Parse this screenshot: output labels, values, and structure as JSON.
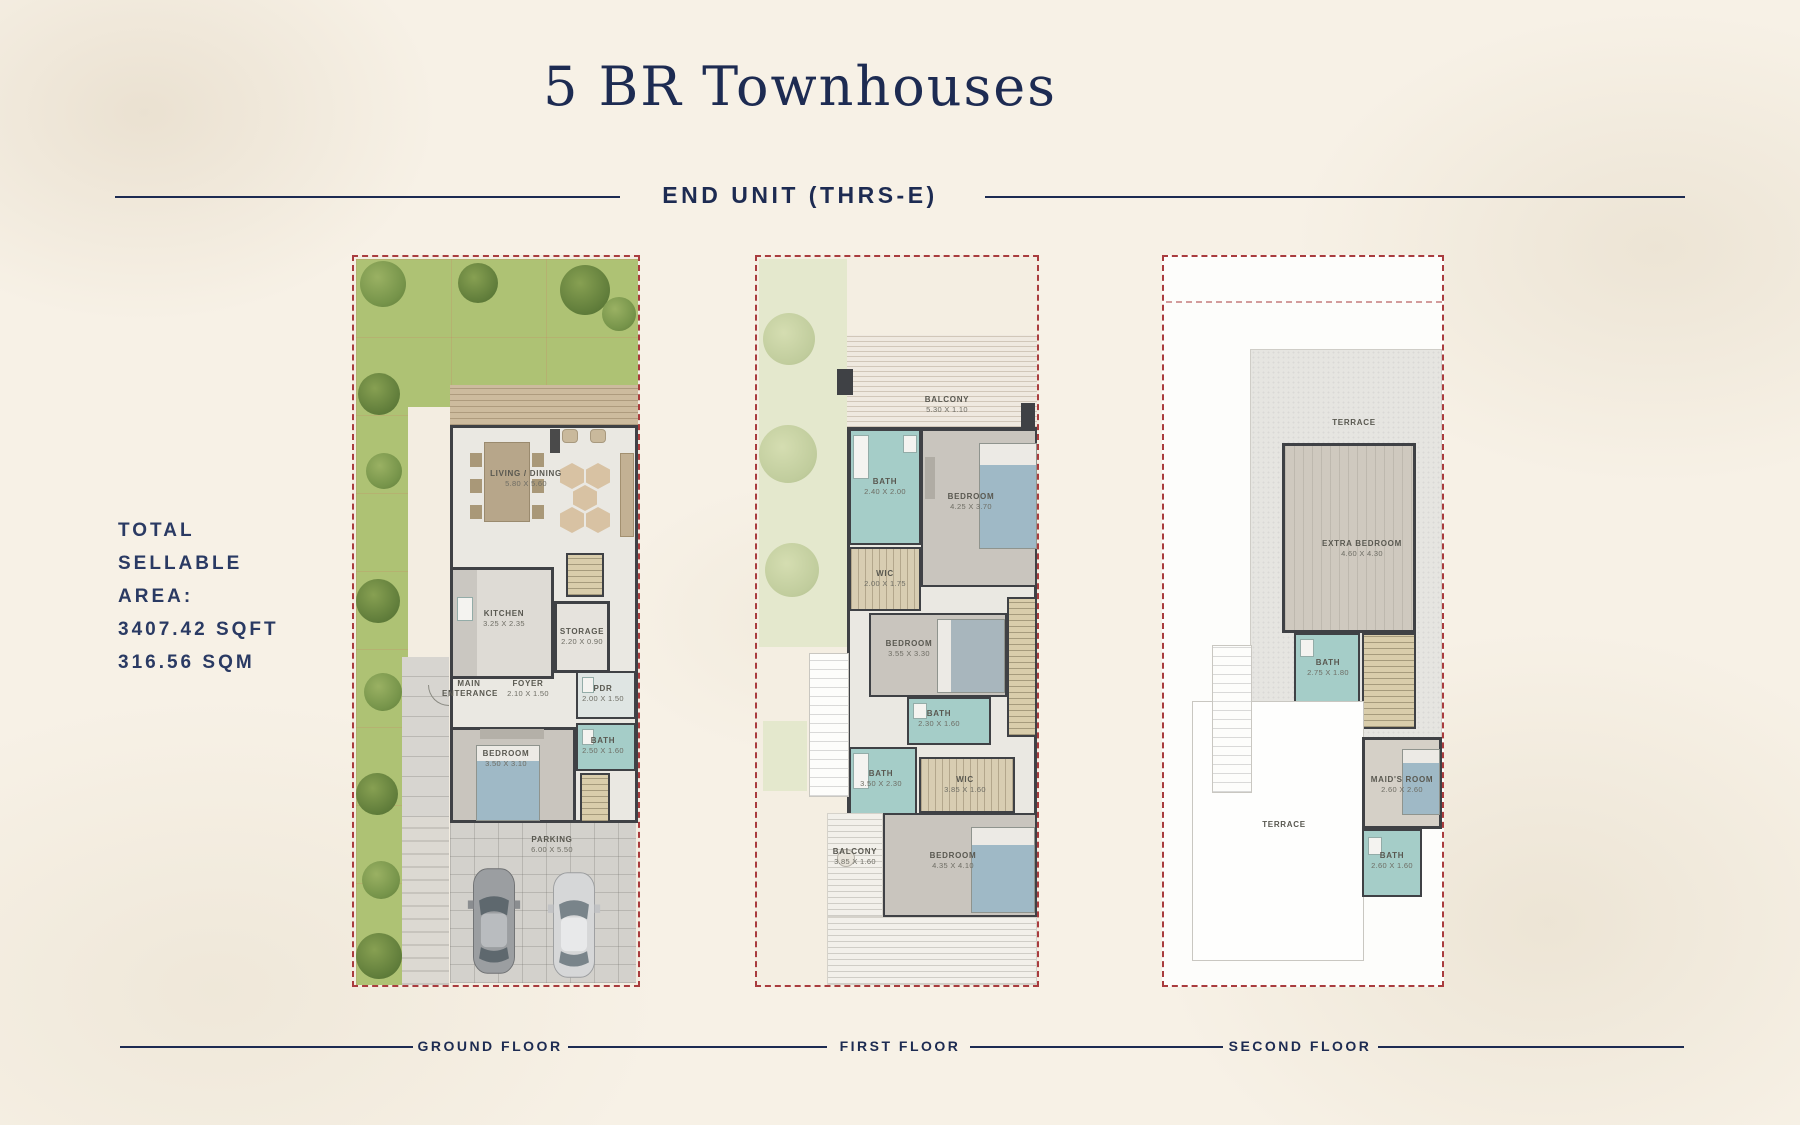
{
  "header": {
    "title": "5 BR Townhouses",
    "subtitle": "END UNIT (THRS-E)"
  },
  "area": {
    "l1": "TOTAL",
    "l2": "SELLABLE",
    "l3": "AREA:",
    "l4": "3407.42 SQFT",
    "l5": "316.56 SQM"
  },
  "floors": {
    "ground": {
      "label": "GROUND FLOOR",
      "rooms": {
        "living": {
          "name": "LIVING / DINING",
          "dims": "5.80 X 5.60"
        },
        "kitchen": {
          "name": "KITCHEN",
          "dims": "3.25 X 2.35"
        },
        "storage": {
          "name": "STORAGE",
          "dims": "2.20 X 0.90"
        },
        "entrance": {
          "name": "MAIN ENTERANCE",
          "dims": ""
        },
        "foyer": {
          "name": "FOYER",
          "dims": "2.10 X 1.50"
        },
        "pdr": {
          "name": "PDR",
          "dims": "2.00 X 1.50"
        },
        "bath": {
          "name": "BATH",
          "dims": "2.50 X 1.60"
        },
        "bedroom": {
          "name": "BEDROOM",
          "dims": "3.50 X 3.10"
        },
        "parking": {
          "name": "PARKING",
          "dims": "6.00 X 5.50"
        }
      }
    },
    "first": {
      "label": "FIRST FLOOR",
      "rooms": {
        "balcony1": {
          "name": "BALCONY",
          "dims": "5.30 X 1.10"
        },
        "bath1": {
          "name": "BATH",
          "dims": "2.40 X 2.00"
        },
        "bedroom1": {
          "name": "BEDROOM",
          "dims": "4.25 X 3.70"
        },
        "wic1": {
          "name": "WIC",
          "dims": "2.00 X 1.75"
        },
        "bedroom2": {
          "name": "BEDROOM",
          "dims": "3.55 X 3.30"
        },
        "bath2": {
          "name": "BATH",
          "dims": "2.30 X 1.60"
        },
        "bath3": {
          "name": "BATH",
          "dims": "3.50 X 2.30"
        },
        "wic2": {
          "name": "WIC",
          "dims": "3.85 X 1.60"
        },
        "bedroom3": {
          "name": "BEDROOM",
          "dims": "4.35 X 4.10"
        },
        "balcony2": {
          "name": "BALCONY",
          "dims": "3.85 X 1.60"
        }
      }
    },
    "second": {
      "label": "SECOND FLOOR",
      "rooms": {
        "terrace1": {
          "name": "TERRACE",
          "dims": ""
        },
        "extra": {
          "name": "EXTRA BEDROOM",
          "dims": "4.60 X 4.30"
        },
        "bath1": {
          "name": "BATH",
          "dims": "2.75 X 1.80"
        },
        "terrace2": {
          "name": "TERRACE",
          "dims": ""
        },
        "maid": {
          "name": "MAID'S ROOM",
          "dims": "2.60 X 2.60"
        },
        "bath2": {
          "name": "BATH",
          "dims": "2.60 X 1.60"
        }
      }
    }
  },
  "colors": {
    "accent_navy": "#1d2b52",
    "boundary_red": "#a93c3e",
    "bath_teal": "#a5cdc8",
    "lawn_green": "#aec274",
    "sage_green": "#e4e8cd",
    "background_cream": "#f7f1e6",
    "wall_dark": "#3f4145"
  }
}
